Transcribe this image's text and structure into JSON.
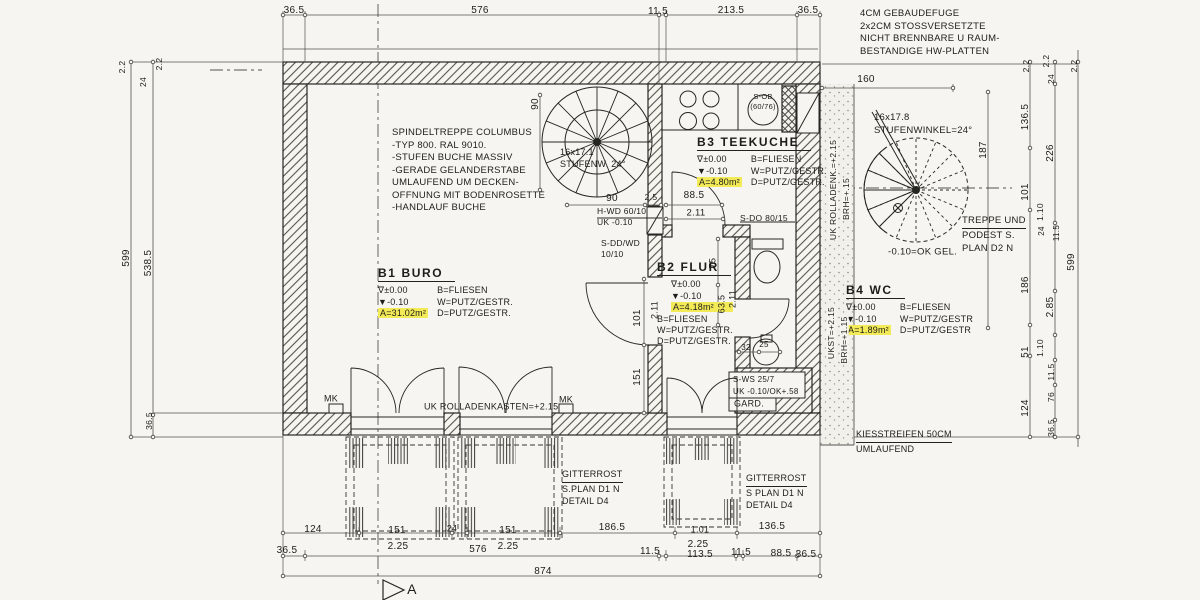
{
  "colors": {
    "highlight": "#f3ea57",
    "paper": "#f6f5f1",
    "ink": "#22221e"
  },
  "rooms": {
    "b1": {
      "name": "B1 BURO",
      "level_zero": "∇±0.00",
      "level_minus": "▼-0.10",
      "area": "A=31.02m²",
      "floor": "B=FLIESEN",
      "walls": "W=PUTZ/GESTR.",
      "ceiling": "D=PUTZ/GESTR."
    },
    "b2": {
      "name": "B2 FLUR",
      "level_zero": "∇±0.00",
      "level_minus": "▼-0.10",
      "area": "A=4.18m²",
      "floor": "B=FLIESEN",
      "walls": "W=PUTZ/GESTR.",
      "ceiling": "D=PUTZ/GESTR."
    },
    "b3": {
      "name": "B3 TEEKUCHE",
      "level_zero": "∇±0.00",
      "level_minus": "▼-0.10",
      "area": "A=4.80m²",
      "floor": "B=FLIESEN",
      "walls": "W=PUTZ/GESTR.",
      "ceiling": "D=PUTZ/GESTR."
    },
    "b4": {
      "name": "B4 WC",
      "level_zero": "∇±0.00",
      "level_minus": "▼-0.10",
      "area": "A=1.89m²",
      "floor": "B=FLIESEN",
      "walls": "W=PUTZ/GESTR",
      "ceiling": "D=PUTZ/GESTR"
    }
  },
  "notes": {
    "fuge": "4CM GEBAUDEFUGE\n2x2CM STOSSVERSETZTE\nNICHT BRENNBARE U RAUM-\nBESTANDIGE HW-PLATTEN",
    "spindeltreppe": "SPINDELTREPPE COLUMBUS\n-TYP 800. RAL 9010.\n-STUFEN BUCHE MASSIV\n-GERADE GELANDERSTABE\n UMLAUFEND UM DECKEN-\n OFFNUNG MIT BODENROSETTE\n-HANDLAUF  BUCHE",
    "stair1": "16x17.1\nSTUFENW. 24°",
    "stair2": "16x17.8\nSTUFENWINKEL=24°",
    "treppe_title": "TREPPE UND",
    "treppe_body": "PODEST S.\nPLAN D2 N",
    "hwd": "H-WD 60/10\nUK -0.10",
    "sddwd": "S-DD/WD\n10/10",
    "sob": "S-OB\n(60/76)",
    "gitterrost_title": "GITTERROST",
    "gitterrost1_body": "S.PLAN D1 N\nDETAIL D4",
    "gitterrost2_body": "S PLAN D1 N\nDETAIL D4",
    "kies_title": "KIESSTREIFEN 50CM",
    "kies_body": "UMLAUFEND"
  },
  "labels": [
    {
      "t": "36.5",
      "x": 294,
      "y": 11
    },
    {
      "t": "576",
      "x": 480,
      "y": 11
    },
    {
      "t": "11.5",
      "x": 658,
      "y": 12
    },
    {
      "t": "213.5",
      "x": 731,
      "y": 11
    },
    {
      "t": "36.5",
      "x": 808,
      "y": 11
    },
    {
      "t": "2.2",
      "x": 122,
      "y": 67,
      "r": -90,
      "s": 8.5
    },
    {
      "t": "24",
      "x": 143,
      "y": 82,
      "r": -90,
      "s": 8.5
    },
    {
      "t": "2.2",
      "x": 159,
      "y": 64,
      "r": -90,
      "s": 8.5
    },
    {
      "t": "599",
      "x": 127,
      "y": 258,
      "r": -90
    },
    {
      "t": "538.5",
      "x": 149,
      "y": 263,
      "r": -90
    },
    {
      "t": "36.5",
      "x": 149,
      "y": 421,
      "r": -90,
      "s": 8.5
    },
    {
      "t": "2.2",
      "x": 1026,
      "y": 66,
      "r": -90,
      "s": 8.5
    },
    {
      "t": "2.2",
      "x": 1046,
      "y": 61,
      "r": -90,
      "s": 8.5
    },
    {
      "t": "24",
      "x": 1051,
      "y": 79,
      "r": -90,
      "s": 8.5
    },
    {
      "t": "2.2",
      "x": 1074,
      "y": 66,
      "r": -90,
      "s": 8.5
    },
    {
      "t": "160",
      "x": 866,
      "y": 80
    },
    {
      "t": "187",
      "x": 984,
      "y": 150,
      "r": -90
    },
    {
      "t": "136.5",
      "x": 1026,
      "y": 117,
      "r": -90
    },
    {
      "t": "226",
      "x": 1051,
      "y": 153,
      "r": -90
    },
    {
      "t": "101",
      "x": 1026,
      "y": 192,
      "r": -90
    },
    {
      "t": "1.10",
      "x": 1040,
      "y": 212,
      "r": -90,
      "s": 8.5
    },
    {
      "t": "24",
      "x": 1042,
      "y": 231,
      "r": -90,
      "s": 8
    },
    {
      "t": "11.5",
      "x": 1057,
      "y": 233,
      "r": -90,
      "s": 8
    },
    {
      "t": "599",
      "x": 1072,
      "y": 262,
      "r": -90
    },
    {
      "t": "186",
      "x": 1026,
      "y": 285,
      "r": -90
    },
    {
      "t": "2.85",
      "x": 1051,
      "y": 307,
      "r": -90
    },
    {
      "t": "1.10",
      "x": 1040,
      "y": 348,
      "r": -90,
      "s": 8.5
    },
    {
      "t": "51",
      "x": 1026,
      "y": 352,
      "r": -90
    },
    {
      "t": "11.5",
      "x": 1051,
      "y": 372,
      "r": -90,
      "s": 8.5
    },
    {
      "t": "76",
      "x": 1051,
      "y": 397,
      "r": -90,
      "s": 8.5
    },
    {
      "t": "124",
      "x": 1026,
      "y": 408,
      "r": -90
    },
    {
      "t": "36.5",
      "x": 1051,
      "y": 428,
      "r": -90,
      "s": 8.5
    },
    {
      "t": "90",
      "x": 536,
      "y": 104,
      "r": -90
    },
    {
      "t": "90",
      "x": 612,
      "y": 199
    },
    {
      "t": "2.5",
      "x": 651,
      "y": 197,
      "s": 8.5
    },
    {
      "t": "88.5",
      "x": 694,
      "y": 196
    },
    {
      "t": "2.11",
      "x": 696,
      "y": 213,
      "s": 9.5
    },
    {
      "t": "101",
      "x": 638,
      "y": 318,
      "r": -90
    },
    {
      "t": "2.11",
      "x": 655,
      "y": 310,
      "r": -90,
      "s": 9
    },
    {
      "t": "151",
      "x": 638,
      "y": 377,
      "r": -90
    },
    {
      "t": "75",
      "x": 713,
      "y": 263,
      "r": -90,
      "s": 9
    },
    {
      "t": "63.5",
      "x": 722,
      "y": 304,
      "r": -90,
      "s": 9
    },
    {
      "t": "2.11",
      "x": 733,
      "y": 299,
      "r": -90,
      "s": 9
    },
    {
      "t": "32",
      "x": 746,
      "y": 348,
      "s": 8
    },
    {
      "t": "25",
      "x": 764,
      "y": 345,
      "s": 8
    },
    {
      "t": "124",
      "x": 313,
      "y": 530
    },
    {
      "t": "151",
      "x": 397,
      "y": 531
    },
    {
      "t": "2.25",
      "x": 398,
      "y": 547
    },
    {
      "t": "24",
      "x": 452,
      "y": 529,
      "s": 9
    },
    {
      "t": "151",
      "x": 508,
      "y": 531
    },
    {
      "t": "2.25",
      "x": 508,
      "y": 547
    },
    {
      "t": "186.5",
      "x": 612,
      "y": 528
    },
    {
      "t": "1.01",
      "x": 700,
      "y": 530,
      "s": 9
    },
    {
      "t": "2.25",
      "x": 698,
      "y": 545
    },
    {
      "t": "136.5",
      "x": 772,
      "y": 527
    },
    {
      "t": "36.5",
      "x": 287,
      "y": 551
    },
    {
      "t": "576",
      "x": 478,
      "y": 550
    },
    {
      "t": "11.5",
      "x": 650,
      "y": 552
    },
    {
      "t": "113.5",
      "x": 700,
      "y": 555
    },
    {
      "t": "11.5",
      "x": 741,
      "y": 553
    },
    {
      "t": "88.5",
      "x": 781,
      "y": 554
    },
    {
      "t": "36.5",
      "x": 806,
      "y": 555
    },
    {
      "t": "874",
      "x": 543,
      "y": 572
    },
    {
      "t": "MK",
      "x": 331,
      "y": 399,
      "s": 9,
      "nm": "mk-label"
    },
    {
      "t": "MK",
      "x": 566,
      "y": 400,
      "s": 9,
      "nm": "mk-label"
    },
    {
      "t": "UK ROLLADENKASTEN=+2.15",
      "x": 424,
      "y": 407,
      "s": 9,
      "al": "l",
      "nm": "rolladenkasten-note"
    },
    {
      "t": "S-DO 80/15",
      "x": 740,
      "y": 218,
      "s": 8.5,
      "al": "l",
      "nm": "lintel-note"
    },
    {
      "t": "S-WS 25/7",
      "x": 733,
      "y": 380,
      "s": 8,
      "al": "l",
      "nm": "lintel-note"
    },
    {
      "t": "UK -0.10/OK+.58",
      "x": 733,
      "y": 392,
      "s": 8,
      "al": "l",
      "nm": "level-note"
    },
    {
      "t": "GARD.",
      "x": 734,
      "y": 404,
      "s": 9,
      "al": "l",
      "nm": "garderobe-label"
    },
    {
      "t": "-0.10=OK GEL.",
      "x": 888,
      "y": 252,
      "s": 9.5,
      "al": "l",
      "nm": "level-note"
    },
    {
      "t": "UK ROLLADENK.=+2.15",
      "x": 833,
      "y": 190,
      "r": -90,
      "s": 8.5,
      "bg": 1,
      "nm": "rolladenk-note"
    },
    {
      "t": "BRH=+.15",
      "x": 846,
      "y": 199,
      "r": -90,
      "s": 8.5,
      "bg": 1,
      "nm": "brh-note"
    },
    {
      "t": "UKST=+2.15",
      "x": 831,
      "y": 333,
      "r": -90,
      "s": 8.5,
      "bg": 1,
      "nm": "ukst-note"
    },
    {
      "t": "BRH=+1.15",
      "x": 844,
      "y": 340,
      "r": -90,
      "s": 8.5,
      "bg": 1,
      "nm": "brh-note"
    },
    {
      "t": "A",
      "x": 412,
      "y": 589,
      "s": 14,
      "nm": "section-letter"
    }
  ]
}
